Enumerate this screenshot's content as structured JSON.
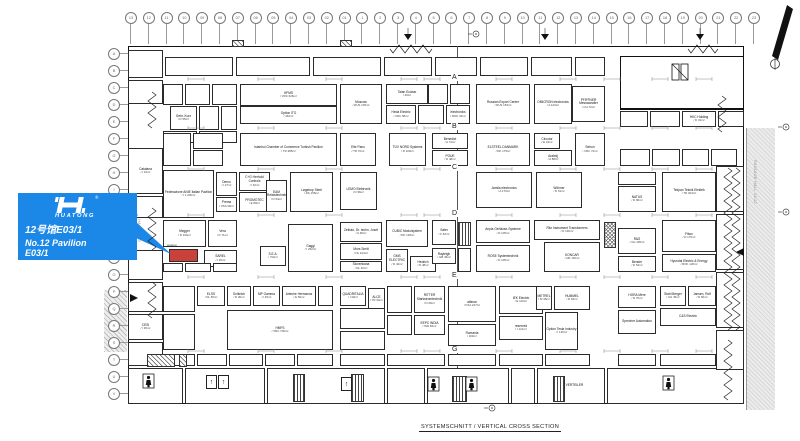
{
  "callout": {
    "logo_text": "HUATONG",
    "registered": "®",
    "line1": "12号馆E03/1",
    "line2": "No.12 Pavilion",
    "line3": "E03/1",
    "bg_color": "#1b87e6",
    "highlight_color": "#c8413a",
    "highlight_booth_label": "Huatong"
  },
  "title_block": {
    "title": "SYSTEMSCHNITT / VERTICAL CROSS SECTION"
  },
  "passages": {
    "right": "PASSAGE HALL 11/12",
    "left": "PASSAGE HALL 12/13"
  },
  "grid": {
    "top": [
      "13",
      "12",
      "11",
      "10",
      "09",
      "08",
      "07",
      "06",
      "05",
      "04",
      "03",
      "02",
      "01",
      "1",
      "2",
      "3",
      "4",
      "5",
      "6",
      "7",
      "8",
      "9",
      "10",
      "11",
      "12",
      "13",
      "14",
      "15",
      "16",
      "17",
      "18",
      "19",
      "20",
      "21",
      "22",
      "23"
    ],
    "left": [
      "A",
      "B",
      "C",
      "D",
      "E",
      "F",
      "G",
      "H",
      "I",
      "K",
      "L",
      "M",
      "N",
      "O",
      "P",
      "Q",
      "R",
      "S",
      "T",
      "U",
      "V"
    ]
  },
  "aisle_labels": [
    {
      "l": "A",
      "y": 74
    },
    {
      "l": "B",
      "y": 123
    },
    {
      "l": "C",
      "y": 164
    },
    {
      "l": "D",
      "y": 210
    },
    {
      "l": "E",
      "y": 272
    },
    {
      "l": "G",
      "y": 346
    }
  ],
  "booths": [
    {
      "n": "HFMS",
      "i": "VRC 626m²",
      "x": 240,
      "y": 84,
      "w": 97,
      "h": 22
    },
    {
      "n": "Option ITO",
      "i": "162m²",
      "x": 240,
      "y": 106,
      "w": 97,
      "h": 18
    },
    {
      "n": "Moscow",
      "i": "RUS 135m²",
      "x": 340,
      "y": 84,
      "w": 42,
      "h": 40
    },
    {
      "n": "Taian Ecobar",
      "i": "40m²",
      "x": 386,
      "y": 84,
      "w": 42,
      "h": 20
    },
    {
      "n": "Heda Electric",
      "i": "VRC 58m²",
      "x": 386,
      "y": 105,
      "w": 30,
      "h": 19
    },
    {
      "n": "electronics",
      "i": "ROK 42m²",
      "x": 446,
      "y": 105,
      "w": 24,
      "h": 19
    },
    {
      "n": "Russian Export Center",
      "i": "RUS 153m²",
      "x": 476,
      "y": 84,
      "w": 54,
      "h": 40
    },
    {
      "n": "OMICRON electronics",
      "i": "A 123m²",
      "x": 534,
      "y": 84,
      "w": 38,
      "h": 40
    },
    {
      "n": "PFIFFNER Messwandler",
      "i": "CH 72m²",
      "x": 572,
      "y": 86,
      "w": 33,
      "h": 36
    },
    {
      "n": "Gebr. Kurz",
      "i": "D 55m²",
      "x": 170,
      "y": 106,
      "w": 27,
      "h": 24
    },
    {
      "n": "Istanbul Chamber of Commerce Turkish Pavilion",
      "i": "TR 385m²",
      "x": 240,
      "y": 133,
      "w": 97,
      "h": 33
    },
    {
      "n": "Elte Pano",
      "i": "TR 70m²",
      "x": 340,
      "y": 133,
      "w": 36,
      "h": 33
    },
    {
      "n": "TÜV NORD Systems",
      "i": "D 100m²",
      "x": 389,
      "y": 133,
      "w": 37,
      "h": 33
    },
    {
      "n": "Benedict",
      "i": "A 72m²",
      "x": 432,
      "y": 133,
      "w": 36,
      "h": 16
    },
    {
      "n": "POUE",
      "i": "D 48m²",
      "x": 432,
      "y": 150,
      "w": 36,
      "h": 16
    },
    {
      "n": "ELSTEEL DANMARK",
      "i": "DK 175m²",
      "x": 476,
      "y": 133,
      "w": 54,
      "h": 33
    },
    {
      "n": "Circutor",
      "i": "E 44m²",
      "x": 534,
      "y": 133,
      "w": 26,
      "h": 16
    },
    {
      "n": "Aralmij",
      "i": "A 88m²",
      "x": 534,
      "y": 150,
      "w": 38,
      "h": 16
    },
    {
      "n": "Sebon",
      "i": "VRC 72m²",
      "x": 575,
      "y": 133,
      "w": 30,
      "h": 33
    },
    {
      "n": "HKC Holding",
      "i": "D 31m²",
      "x": 682,
      "y": 111,
      "w": 34,
      "h": 16
    },
    {
      "n": "Federazione ANIE Italian Pavilion",
      "i": "I 1.200m²",
      "x": 163,
      "y": 170,
      "w": 51,
      "h": 48
    },
    {
      "n": "Demo",
      "i": "I 27m²",
      "x": 216,
      "y": 172,
      "w": 21,
      "h": 24
    },
    {
      "n": "Prema",
      "i": "USA 30m²",
      "x": 216,
      "y": 197,
      "w": 21,
      "h": 15
    },
    {
      "n": "C+G Herhold Controls",
      "i": "I 40m²",
      "x": 239,
      "y": 172,
      "w": 31,
      "h": 19
    },
    {
      "n": "PROMOTEC",
      "i": "E 80m²",
      "x": 239,
      "y": 192,
      "w": 31,
      "h": 20
    },
    {
      "n": "EAM Relaistechnik",
      "i": "D 54m²",
      "x": 266,
      "y": 180,
      "w": 21,
      "h": 32
    },
    {
      "n": "Løgstrup Steel",
      "i": "DK 165m²",
      "x": 290,
      "y": 172,
      "w": 43,
      "h": 40
    },
    {
      "n": "LEMO Elektronik",
      "i": "D 96m²",
      "x": 340,
      "y": 172,
      "w": 37,
      "h": 38
    },
    {
      "n": "Jamila electronics",
      "i": "A 170m²",
      "x": 476,
      "y": 172,
      "w": 56,
      "h": 36
    },
    {
      "n": "Wöhner",
      "i": "D 51m²",
      "x": 536,
      "y": 172,
      "w": 46,
      "h": 36
    },
    {
      "n": "NATUS",
      "i": "D 96m²",
      "x": 618,
      "y": 186,
      "w": 38,
      "h": 26
    },
    {
      "n": "Tekpan Teknik Elektrik",
      "i": "TR 204m²",
      "x": 662,
      "y": 172,
      "w": 54,
      "h": 40
    },
    {
      "n": "Megger",
      "i": "D 104m²",
      "x": 163,
      "y": 220,
      "w": 43,
      "h": 27
    },
    {
      "n": "Vera",
      "i": "D 71m²",
      "x": 208,
      "y": 220,
      "w": 29,
      "h": 27
    },
    {
      "n": "",
      "i": "",
      "x": 169,
      "y": 249,
      "w": 29,
      "h": 13,
      "hl": true
    },
    {
      "n": "SAREL",
      "i": "I 36m²",
      "x": 204,
      "y": 250,
      "w": 33,
      "h": 17
    },
    {
      "n": "S.E.A.",
      "i": "I 54m²",
      "x": 260,
      "y": 246,
      "w": 26,
      "h": 20
    },
    {
      "n": "Gaggi",
      "i": "I 252m²",
      "x": 288,
      "y": 224,
      "w": 45,
      "h": 48
    },
    {
      "n": "Zelisko, Dr. techn. Josef",
      "i": "A 90m²",
      "x": 340,
      "y": 222,
      "w": 42,
      "h": 20
    },
    {
      "n": "Mors Smitt",
      "i": "NL 104m²",
      "x": 340,
      "y": 243,
      "w": 42,
      "h": 17
    },
    {
      "n": "Slovenkana",
      "i": "NL 40m²",
      "x": 340,
      "y": 261,
      "w": 42,
      "h": 11
    },
    {
      "n": "CUBIC Modulsystem",
      "i": "DK 130m²",
      "x": 386,
      "y": 220,
      "w": 42,
      "h": 27
    },
    {
      "n": "GMS ELECTRIC",
      "i": "D 42m²",
      "x": 386,
      "y": 249,
      "w": 22,
      "h": 23
    },
    {
      "n": "Hedrich",
      "i": "D 48m²",
      "x": 410,
      "y": 256,
      "w": 26,
      "h": 16
    },
    {
      "n": "Safer",
      "i": "F 52m²",
      "x": 432,
      "y": 220,
      "w": 24,
      "h": 25
    },
    {
      "n": "Rayleigh",
      "i": "GB 46m²",
      "x": 432,
      "y": 248,
      "w": 24,
      "h": 16
    },
    {
      "n": "Anpla Gehäuse-Systeme",
      "i": "D 105m²",
      "x": 476,
      "y": 220,
      "w": 54,
      "h": 23
    },
    {
      "n": "ROSE Systemtechnik",
      "i": "D 105m²",
      "x": 476,
      "y": 245,
      "w": 54,
      "h": 27
    },
    {
      "n": "Ritz Instrument Transformers",
      "i": "D 130m²",
      "x": 534,
      "y": 220,
      "w": 66,
      "h": 20
    },
    {
      "n": "KONCAR",
      "i": "HR 130m²",
      "x": 544,
      "y": 242,
      "w": 56,
      "h": 30
    },
    {
      "n": "R&S",
      "i": "CH 105m²",
      "x": 618,
      "y": 228,
      "w": 38,
      "h": 26
    },
    {
      "n": "Bender",
      "i": "D 54m²",
      "x": 618,
      "y": 256,
      "w": 38,
      "h": 16
    },
    {
      "n": "Fibox",
      "i": "D 176m²",
      "x": 662,
      "y": 220,
      "w": 54,
      "h": 32
    },
    {
      "n": "Hyundai Electric & Energy",
      "i": "ROK 126m²",
      "x": 662,
      "y": 254,
      "w": 54,
      "h": 18
    },
    {
      "n": "ELSS",
      "i": "NL 50m²",
      "x": 197,
      "y": 286,
      "w": 28,
      "h": 20
    },
    {
      "n": "Schleich",
      "i": "D 30m²",
      "x": 227,
      "y": 286,
      "w": 24,
      "h": 20
    },
    {
      "n": "MP Gamma",
      "i": "I 45m²",
      "x": 253,
      "y": 286,
      "w": 27,
      "h": 20
    },
    {
      "n": "Arteche Hermanos",
      "i": "E 50m²",
      "x": 282,
      "y": 286,
      "w": 34,
      "h": 20
    },
    {
      "n": "HMFS",
      "i": "VRC 706m²",
      "x": 227,
      "y": 310,
      "w": 106,
      "h": 40
    },
    {
      "n": "QUADRITALIA",
      "i": "I 40m²",
      "x": 340,
      "y": 286,
      "w": 26,
      "h": 20
    },
    {
      "n": "ALCE",
      "i": "TR 34m²",
      "x": 368,
      "y": 288,
      "w": 17,
      "h": 22
    },
    {
      "n": "RITTER Starkstromtechnik",
      "i": "D 60m²",
      "x": 414,
      "y": 286,
      "w": 31,
      "h": 27
    },
    {
      "n": "EEPC INDIA",
      "i": "IND 84m²",
      "x": 414,
      "y": 315,
      "w": 31,
      "h": 20
    },
    {
      "n": "alfanar",
      "i": "KSA 247m²",
      "x": 448,
      "y": 286,
      "w": 48,
      "h": 36
    },
    {
      "n": "Romania",
      "i": "100m²",
      "x": 448,
      "y": 324,
      "w": 48,
      "h": 22
    },
    {
      "n": "IEK Electric",
      "i": "E 110m²",
      "x": 499,
      "y": 286,
      "w": 44,
      "h": 28
    },
    {
      "n": "reserved",
      "i": "I 121m²",
      "x": 499,
      "y": 316,
      "w": 44,
      "h": 24
    },
    {
      "n": "METREL",
      "i": "SI 35m²",
      "x": 536,
      "y": 286,
      "w": 16,
      "h": 24
    },
    {
      "n": "HUMMEL",
      "i": "D 63m²",
      "x": 554,
      "y": 286,
      "w": 36,
      "h": 24
    },
    {
      "n": "Option Tesla Industry",
      "i": "I 136m²",
      "x": 545,
      "y": 312,
      "w": 33,
      "h": 38
    },
    {
      "n": "HORA Mere",
      "i": "D 70m²",
      "x": 618,
      "y": 286,
      "w": 38,
      "h": 22
    },
    {
      "n": "Sprecher Automation",
      "i": "",
      "x": 618,
      "y": 310,
      "w": 38,
      "h": 24
    },
    {
      "n": "Stahl Berger",
      "i": "CH 45m²",
      "x": 660,
      "y": 286,
      "w": 26,
      "h": 20
    },
    {
      "n": "Jansen, Rolf",
      "i": "D 60m²",
      "x": 688,
      "y": 286,
      "w": 28,
      "h": 20
    },
    {
      "n": "C&S Electric",
      "i": "",
      "x": 660,
      "y": 308,
      "w": 56,
      "h": 18
    },
    {
      "n": "CESI",
      "i": "I 36m²",
      "x": 128,
      "y": 314,
      "w": 35,
      "h": 26
    },
    {
      "n": "Catalana",
      "i": "I 34m²",
      "x": 128,
      "y": 148,
      "w": 35,
      "h": 46
    },
    {
      "n": "ELT. VERTEILER",
      "i": "",
      "x": 537,
      "y": 368,
      "w": 68,
      "h": 36
    }
  ],
  "filler_booths": [
    [
      165,
      57,
      68,
      19
    ],
    [
      236,
      57,
      74,
      19
    ],
    [
      313,
      57,
      68,
      19
    ],
    [
      384,
      57,
      48,
      19
    ],
    [
      435,
      57,
      42,
      19
    ],
    [
      480,
      57,
      48,
      19
    ],
    [
      531,
      57,
      41,
      19
    ],
    [
      575,
      57,
      30,
      19
    ],
    [
      163,
      84,
      20,
      21
    ],
    [
      185,
      84,
      25,
      21
    ],
    [
      212,
      84,
      25,
      21
    ],
    [
      199,
      106,
      20,
      24
    ],
    [
      221,
      106,
      16,
      24
    ],
    [
      163,
      131,
      34,
      12
    ],
    [
      199,
      131,
      38,
      12
    ],
    [
      428,
      84,
      20,
      20
    ],
    [
      450,
      84,
      20,
      20
    ],
    [
      418,
      105,
      26,
      19
    ],
    [
      163,
      133,
      28,
      33
    ],
    [
      193,
      133,
      30,
      16
    ],
    [
      193,
      150,
      30,
      16
    ],
    [
      620,
      111,
      28,
      16
    ],
    [
      650,
      111,
      30,
      16
    ],
    [
      718,
      111,
      26,
      16
    ],
    [
      620,
      149,
      30,
      17
    ],
    [
      652,
      149,
      28,
      17
    ],
    [
      682,
      149,
      27,
      17
    ],
    [
      711,
      149,
      26,
      17
    ],
    [
      618,
      172,
      38,
      13
    ],
    [
      163,
      263,
      20,
      9
    ],
    [
      185,
      263,
      26,
      9
    ],
    [
      213,
      263,
      24,
      9
    ],
    [
      458,
      248,
      13,
      24
    ],
    [
      163,
      286,
      32,
      26
    ],
    [
      163,
      314,
      32,
      36
    ],
    [
      318,
      286,
      15,
      20
    ],
    [
      387,
      286,
      25,
      27
    ],
    [
      387,
      315,
      25,
      20
    ],
    [
      340,
      308,
      45,
      21
    ],
    [
      340,
      331,
      45,
      19
    ],
    [
      165,
      354,
      30,
      12
    ],
    [
      197,
      354,
      30,
      12
    ],
    [
      229,
      354,
      34,
      12
    ],
    [
      265,
      354,
      30,
      12
    ],
    [
      297,
      354,
      36,
      12
    ],
    [
      340,
      354,
      45,
      12
    ],
    [
      387,
      354,
      58,
      12
    ],
    [
      448,
      354,
      48,
      12
    ],
    [
      499,
      354,
      44,
      12
    ],
    [
      545,
      354,
      45,
      12
    ],
    [
      618,
      354,
      38,
      12
    ],
    [
      660,
      354,
      56,
      12
    ],
    [
      128,
      368,
      55,
      36
    ],
    [
      185,
      368,
      80,
      36
    ],
    [
      267,
      368,
      118,
      36
    ],
    [
      387,
      368,
      38,
      36
    ],
    [
      427,
      368,
      82,
      36
    ],
    [
      511,
      368,
      24,
      36
    ],
    [
      607,
      368,
      137,
      36
    ],
    [
      128,
      50,
      35,
      28
    ],
    [
      128,
      80,
      35,
      24
    ],
    [
      128,
      196,
      35,
      22
    ],
    [
      128,
      250,
      35,
      30
    ],
    [
      128,
      282,
      35,
      30
    ],
    [
      128,
      342,
      35,
      24
    ],
    [
      716,
      166,
      28,
      46
    ],
    [
      716,
      214,
      28,
      56
    ],
    [
      716,
      272,
      28,
      56
    ],
    [
      716,
      330,
      28,
      40
    ]
  ],
  "structures": {
    "diag": [
      [
        147,
        354,
        28,
        13
      ],
      [
        179,
        354,
        8,
        13
      ],
      [
        232,
        40,
        12,
        7
      ],
      [
        340,
        40,
        12,
        7
      ]
    ],
    "vert": [
      [
        293,
        374,
        12,
        28
      ],
      [
        351,
        374,
        13,
        28
      ],
      [
        452,
        376,
        15,
        26
      ],
      [
        553,
        376,
        12,
        26
      ],
      [
        458,
        222,
        13,
        24
      ]
    ],
    "cross": [
      [
        604,
        222,
        12,
        26
      ]
    ]
  }
}
